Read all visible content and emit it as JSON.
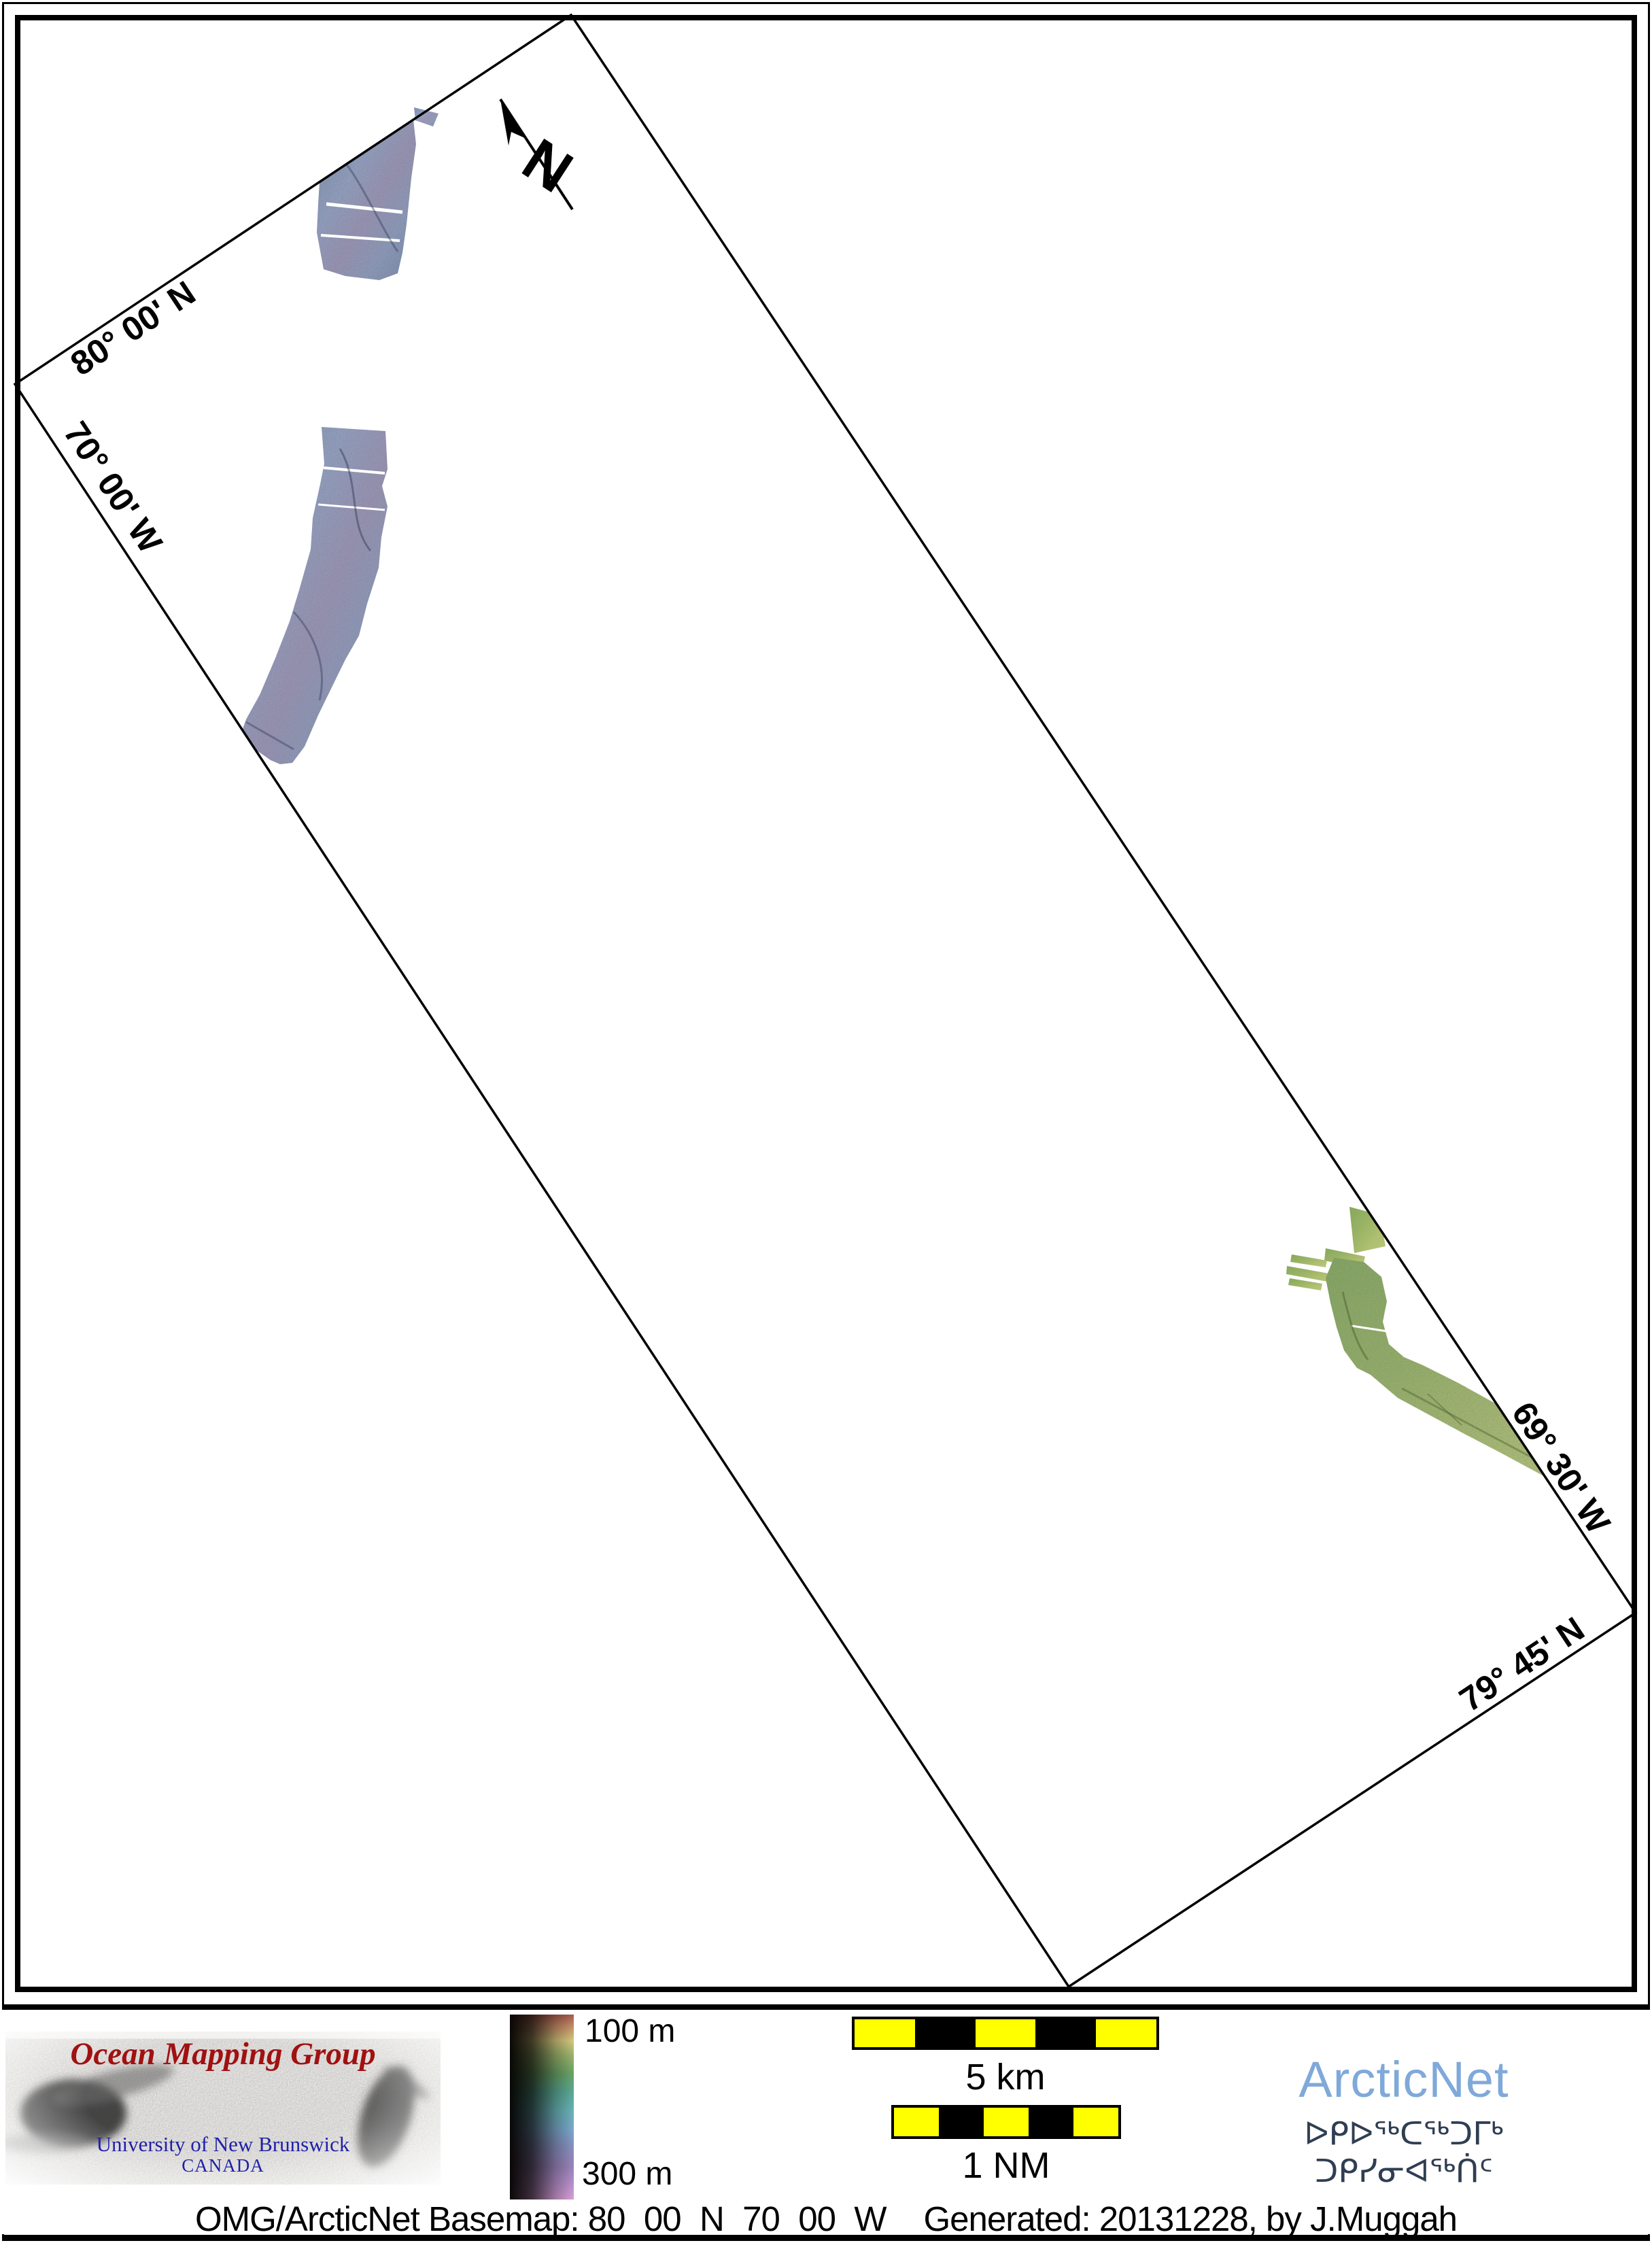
{
  "map": {
    "labels": {
      "top_lat": "80° 00' N",
      "left_lon": "70° 00' W",
      "right_lon": "69° 30' W",
      "bottom_lat": "79° 45' N"
    },
    "north_arrow": "N",
    "swath_colors": {
      "north_swaths": "#8b9ab8",
      "south_swath": "#9ab365"
    }
  },
  "legend": {
    "logo": {
      "title": "Ocean Mapping Group",
      "university": "University of New Brunswick",
      "country": "CANADA",
      "title_color": "#a01111",
      "text_color": "#2020a8"
    },
    "depth_scale": {
      "top": "100 m",
      "bottom": "300 m",
      "min_m": 100,
      "max_m": 300
    },
    "scalebar_km": "5 km",
    "scalebar_nm": "1 NM",
    "scalebar_yellow": "#ffff00",
    "scalebar_black": "#000000",
    "arcticnet": {
      "name": "ArcticNet",
      "color": "#7fa9d9",
      "inuktitut": "ᐅᑭᐅᖅᑕᖅᑐᒥᒃ ᑐᑭᓯᓂᐊᖅᑏᑦ",
      "inuktitut_color": "#2f3e52"
    }
  },
  "footer": {
    "basemap": "OMG/ArcticNet Basemap: 80_00_N_70_00_W",
    "generated": "Generated: 20131228, by J.Muggah"
  }
}
